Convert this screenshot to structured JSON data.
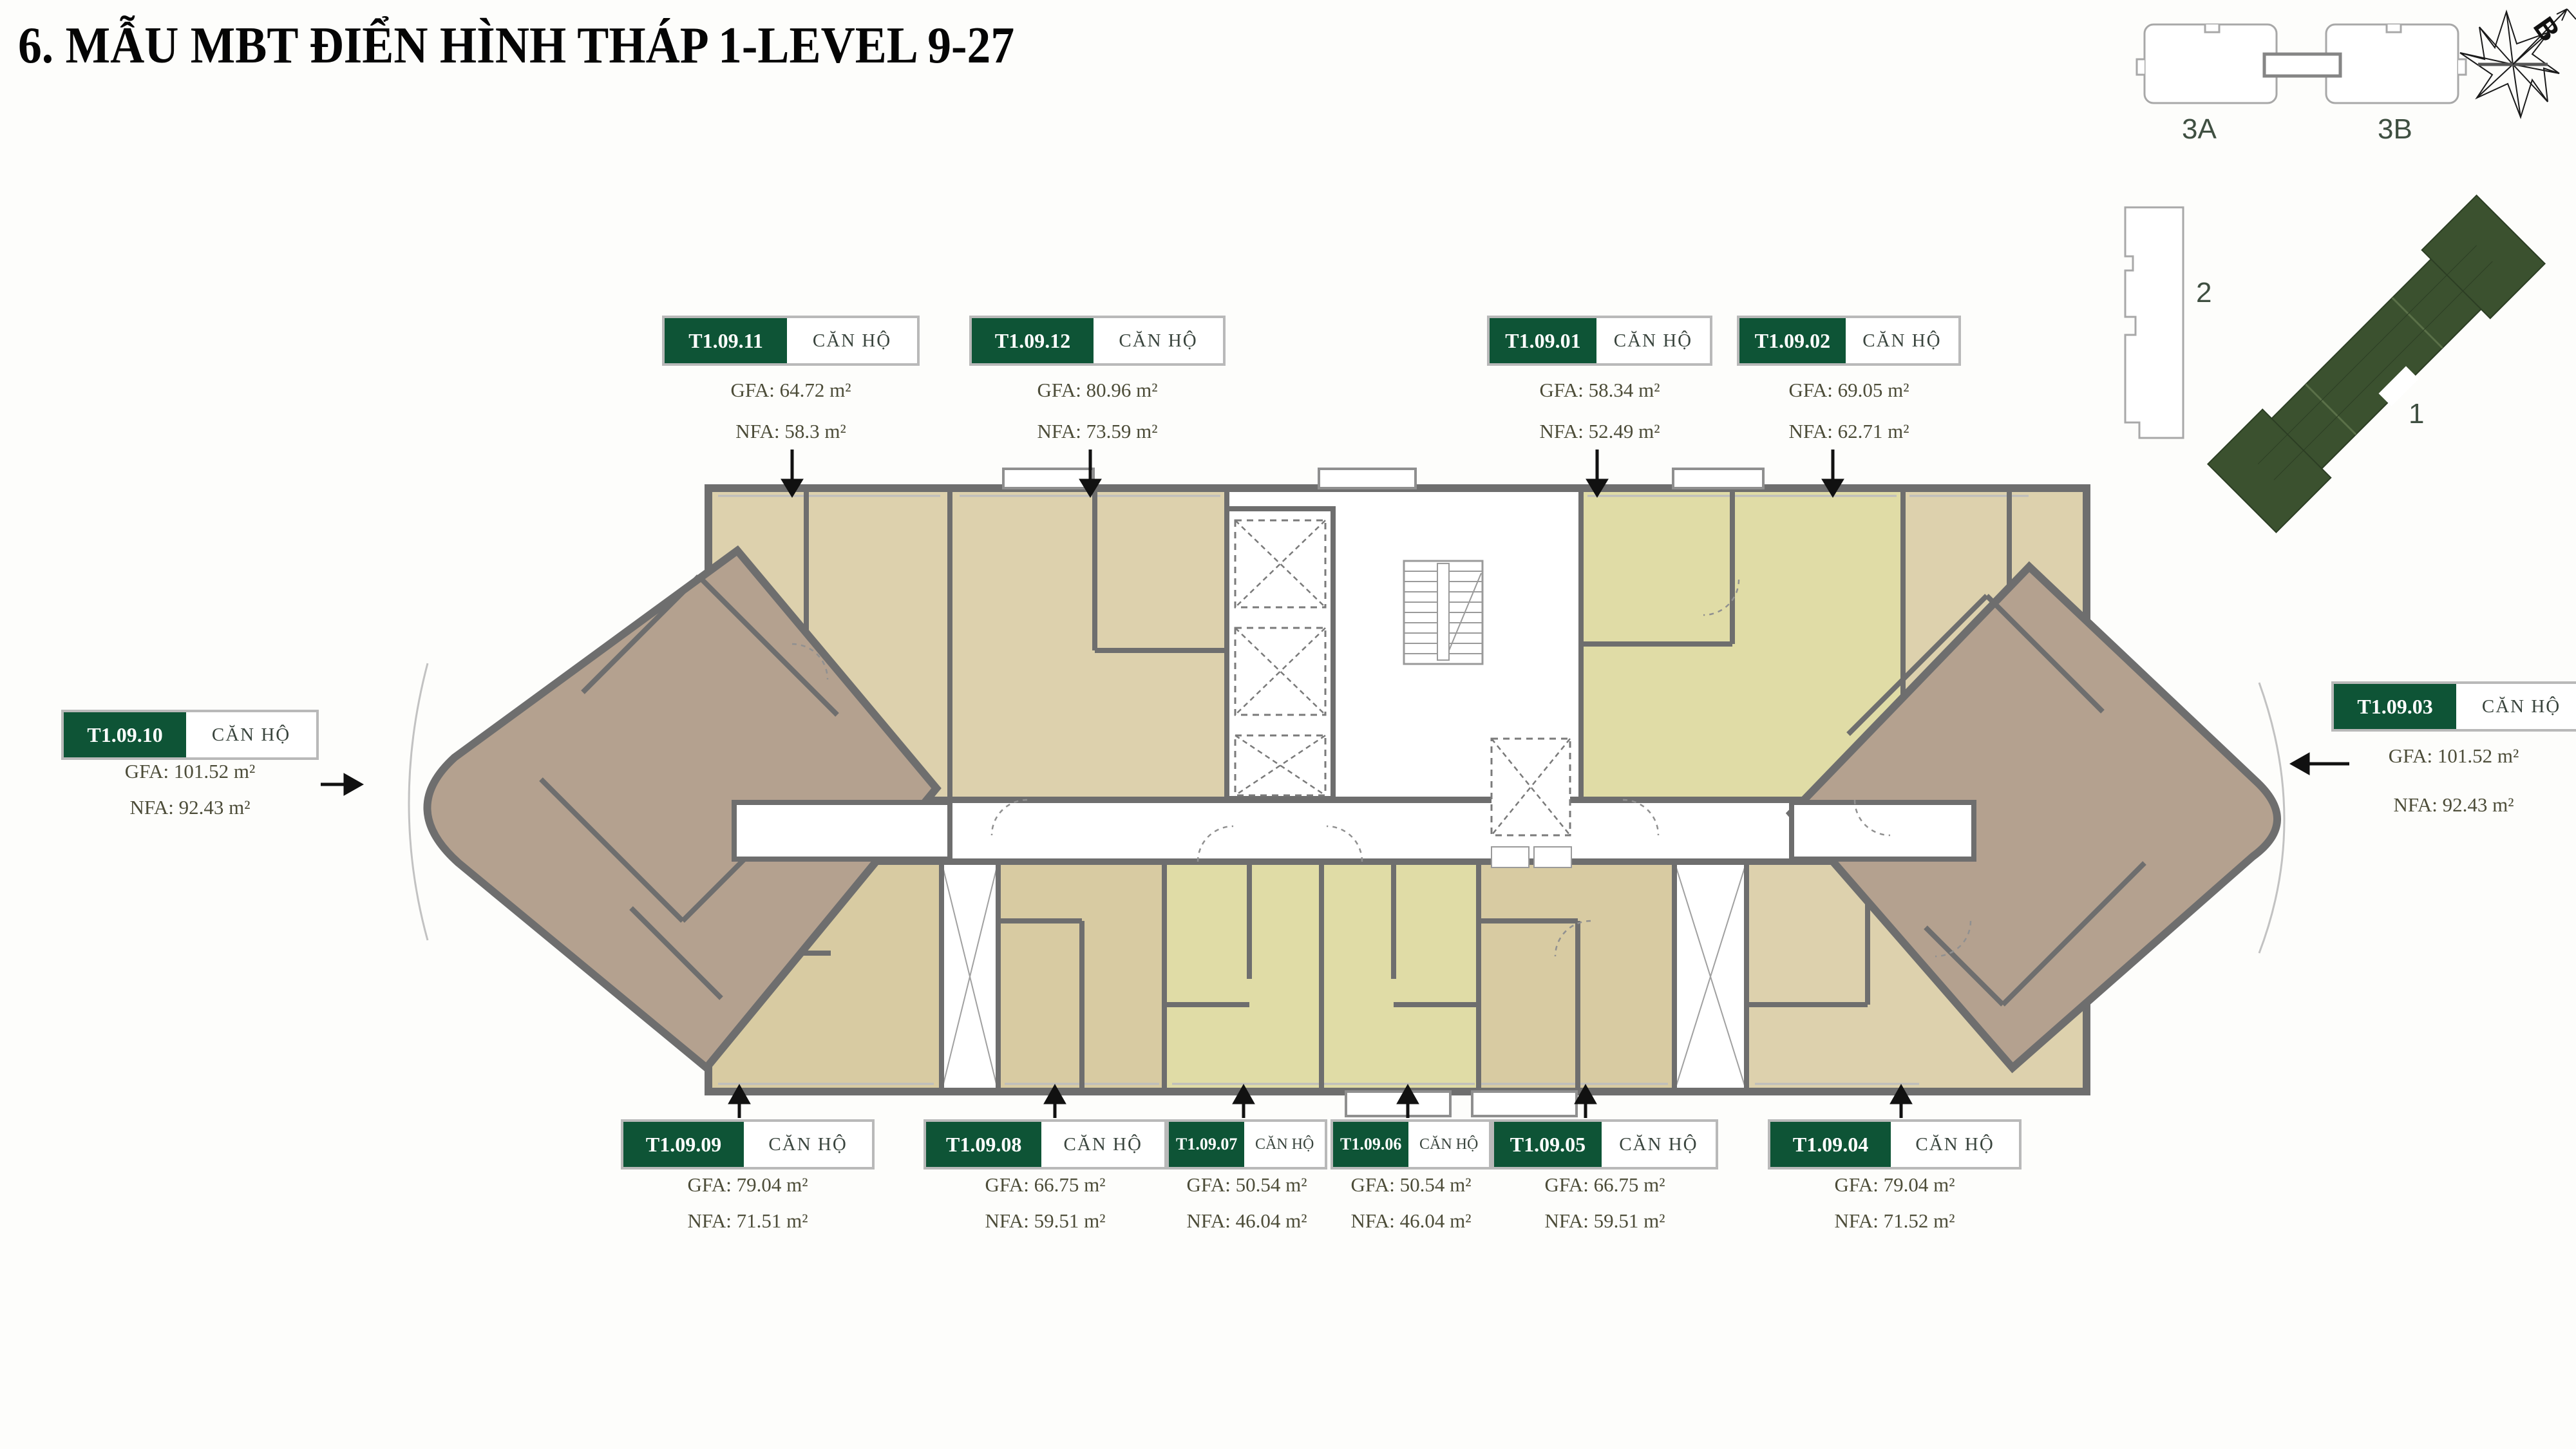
{
  "title": "6. MẪU MBT ĐIỂN HÌNH THÁP 1-LEVEL 9-27",
  "keyplan": {
    "block_3a": "3A",
    "block_3b": "3B",
    "block_2": "2",
    "block_1": "1",
    "north_letter": "B"
  },
  "units": [
    {
      "code": "T1.09.11",
      "type": "CĂN HỘ",
      "gfa": "GFA: 64.72 m²",
      "nfa": "NFA: 58.3 m²"
    },
    {
      "code": "T1.09.12",
      "type": "CĂN HỘ",
      "gfa": "GFA: 80.96 m²",
      "nfa": "NFA: 73.59 m²"
    },
    {
      "code": "T1.09.01",
      "type": "CĂN HỘ",
      "gfa": "GFA: 58.34 m²",
      "nfa": "NFA: 52.49 m²"
    },
    {
      "code": "T1.09.02",
      "type": "CĂN HỘ",
      "gfa": "GFA: 69.05 m²",
      "nfa": "NFA: 62.71 m²"
    },
    {
      "code": "T1.09.10",
      "type": "CĂN HỘ",
      "gfa": "GFA: 101.52 m²",
      "nfa": "NFA: 92.43 m²"
    },
    {
      "code": "T1.09.03",
      "type": "CĂN HỘ",
      "gfa": "GFA: 101.52 m²",
      "nfa": "NFA: 92.43 m²"
    },
    {
      "code": "T1.09.09",
      "type": "CĂN HỘ",
      "gfa": "GFA: 79.04 m²",
      "nfa": "NFA: 71.51 m²"
    },
    {
      "code": "T1.09.08",
      "type": "CĂN HỘ",
      "gfa": "GFA: 66.75 m²",
      "nfa": "NFA: 59.51 m²"
    },
    {
      "code": "T1.09.07",
      "type": "CĂN HỘ",
      "gfa": "GFA: 50.54 m²",
      "nfa": "NFA: 46.04 m²"
    },
    {
      "code": "T1.09.06",
      "type": "CĂN HỘ",
      "gfa": "GFA: 50.54 m²",
      "nfa": "NFA: 46.04 m²"
    },
    {
      "code": "T1.09.05",
      "type": "CĂN HỘ",
      "gfa": "GFA: 66.75 m²",
      "nfa": "NFA: 59.51 m²"
    },
    {
      "code": "T1.09.04",
      "type": "CĂN HỘ",
      "gfa": "GFA: 79.04 m²",
      "nfa": "NFA: 71.52 m²"
    }
  ],
  "colors": {
    "label_green": "#0e5436",
    "beige_unit": "#ddd1ad",
    "yellow_unit": "#e0dca6",
    "brown_wing": "#b4a18f",
    "wall_gray": "#6e6e6e",
    "keyplan_green": "#3b512f"
  }
}
